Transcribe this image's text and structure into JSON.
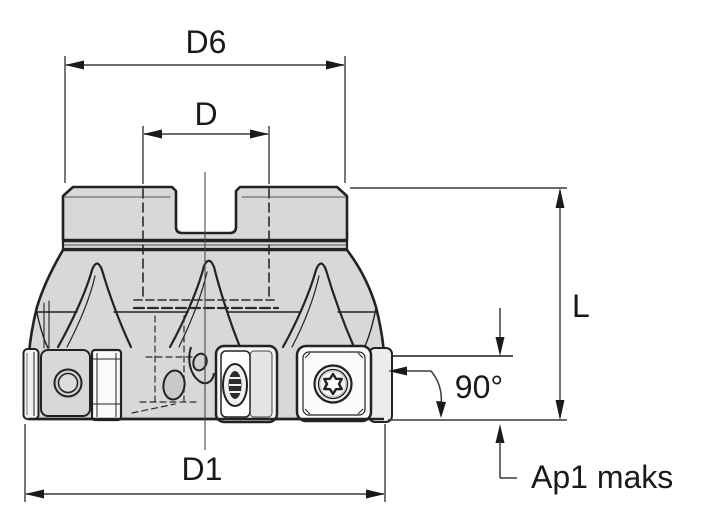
{
  "diagram": {
    "type": "technical-drawing",
    "subject": "face-milling-cutter-side-view-with-indexable-inserts",
    "labels": {
      "d6": "D6",
      "d": "D",
      "l": "L",
      "angle": "90°",
      "d1": "D1",
      "ap1_max": "Ap1 maks"
    },
    "colors": {
      "background": "#ffffff",
      "body_fill": "#d8d8d8",
      "outline": "#222222",
      "dimension_line": "#3c3c3c",
      "text": "#1a1a1a"
    }
  }
}
